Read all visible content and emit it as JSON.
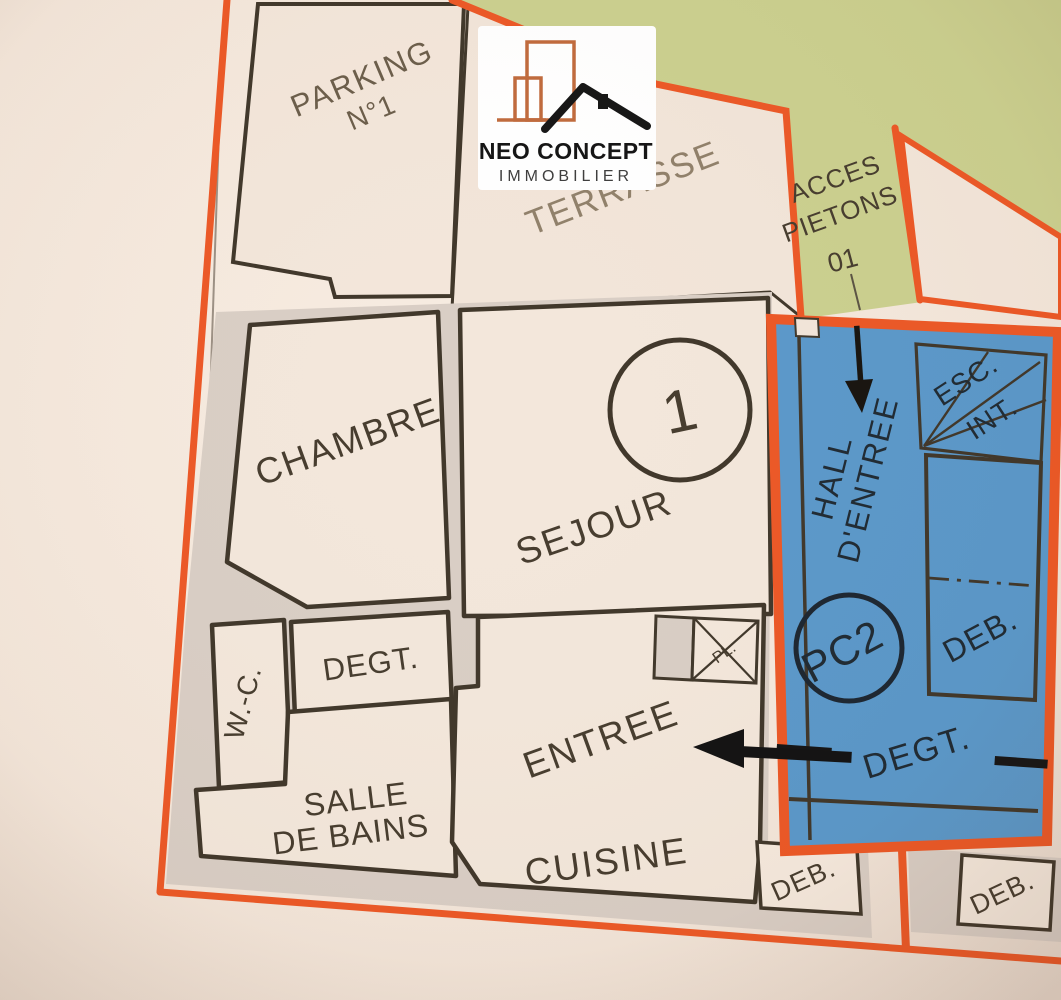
{
  "colors": {
    "orange": "#ec5826",
    "green": "#cbd08f",
    "blue": "#5a98ca",
    "paper": "#f5e9de",
    "wall_gray": "#d9cec5",
    "plan_line": "#40372a",
    "label": "#463c2e",
    "faded_label": "#90806a",
    "blue_area_label": "#1f2a33",
    "logo_orange": "#c06a3c",
    "logo_black": "#151515"
  },
  "logo": {
    "name": "NEO CONCEPT",
    "tagline": "IMMOBILIER"
  },
  "site": {
    "access_label_line1": "ACCES",
    "access_label_line2": "PIETONS",
    "access_code": "01"
  },
  "apartment": {
    "lot_number": "1",
    "parking_line1": "PARKING",
    "parking_line2": "N°1",
    "terrasse": "TERRASSE",
    "chambre": "CHAMBRE",
    "sejour": "SEJOUR",
    "degt": "DEGT.",
    "wc": "W.-C.",
    "bath_line1": "SALLE",
    "bath_line2": "DE BAINS",
    "entree": "ENTREE",
    "cuisine": "CUISINE",
    "deb": "DEB.",
    "placard": "PL."
  },
  "common": {
    "hall_line1": "HALL",
    "hall_line2": "D'ENTREE",
    "stairs_line1": "ESC.",
    "stairs_line2": "INT.",
    "pc_ref": "PC2",
    "degt": "DEGT.",
    "deb": "DEB.",
    "deb_south": "DEB."
  }
}
